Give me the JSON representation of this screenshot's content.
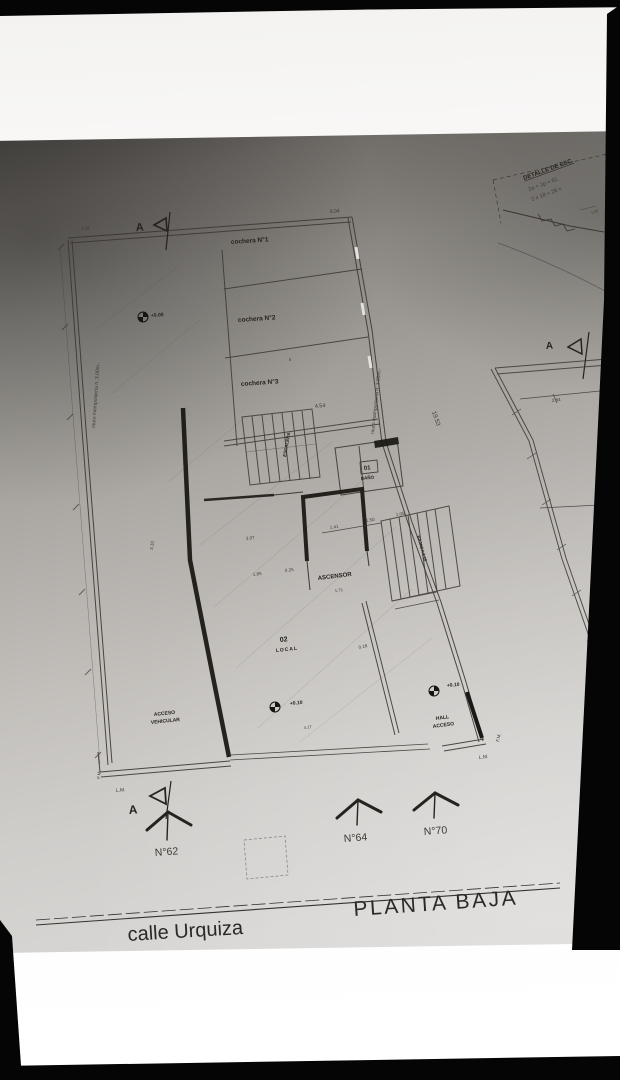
{
  "meta": {
    "description": "Photograph of an architectural ground-floor plan drawing",
    "drawing_title": "PLANTA BAJA",
    "street_label": "calle Urquiza",
    "ink_color": "#3b3834",
    "bold_ink_color": "#26231f",
    "paper_dark": "#4f4c48",
    "paper_light": "#dbd9d7"
  },
  "plan": {
    "title": "PLANTA BAJA",
    "street": "calle Urquiza",
    "detail_note": [
      "DETALLE DE ESC.",
      "2a + 1p = 61",
      "2 x 18 + 26 ="
    ],
    "entries": [
      "N°62",
      "N°64",
      "N°70"
    ],
    "rooms": [
      "cochera N°1",
      "cochera N°2",
      "cochera N°3",
      "LOCAL 02",
      "BAÑO 01",
      "ASCENSOR",
      "ACCESO VEHICULAR",
      "HALL ACCESO"
    ],
    "levels": [
      "+0.00",
      "+0.10",
      "+0.10"
    ],
    "texts": [
      {
        "n": "lm-label-top",
        "t": "L.M.",
        "x": 82,
        "y": 230,
        "s": 4.5,
        "r": -4
      },
      {
        "n": "dim-8-04",
        "t": "8.04",
        "x": 330,
        "y": 213,
        "s": 5,
        "r": -4
      },
      {
        "n": "section-a-top-label",
        "t": "A",
        "x": 136,
        "y": 231,
        "s": 11,
        "r": -4,
        "b": 1
      },
      {
        "n": "room-label-cochera-1",
        "t": "cochera  N°1",
        "x": 231,
        "y": 244,
        "s": 6.5,
        "r": -4,
        "b": 1
      },
      {
        "n": "room-label-cochera-2",
        "t": "cochera  N°2",
        "x": 238,
        "y": 322,
        "s": 6.5,
        "r": -4,
        "b": 1
      },
      {
        "n": "room-label-cochera-3",
        "t": "cochera  N°3",
        "x": 241,
        "y": 386,
        "s": 6.5,
        "r": -4,
        "b": 1
      },
      {
        "n": "wall-label-muro-left",
        "t": "muro mampostería h: 3.00m.-",
        "x": 95,
        "y": 428,
        "s": 5,
        "r": -86
      },
      {
        "n": "wall-label-muro-right",
        "t": "muro mampostería h: 3.00m.-",
        "x": 374,
        "y": 434,
        "s": 5,
        "r": -84
      },
      {
        "n": "level-marker-patio-label",
        "t": "+0.00",
        "x": 151,
        "y": 317,
        "s": 5,
        "r": -4,
        "b": 1
      },
      {
        "n": "dim-5",
        "t": "5",
        "x": 289,
        "y": 361,
        "s": 4,
        "r": -5
      },
      {
        "n": "dim-4-54",
        "t": "4.54",
        "x": 315,
        "y": 408,
        "s": 5.5,
        "r": -6
      },
      {
        "n": "dim-19-53",
        "t": "19.53",
        "x": 432,
        "y": 412,
        "s": 6,
        "r": 71
      },
      {
        "n": "stair-label-escalera",
        "t": "ESCALERA",
        "x": 286,
        "y": 457,
        "s": 4.5,
        "r": -80,
        "b": 1
      },
      {
        "n": "room-label-bano-number",
        "t": "01",
        "x": 364,
        "y": 470,
        "s": 6,
        "r": -6,
        "b": 1
      },
      {
        "n": "room-label-bano",
        "t": "BAÑO",
        "x": 361,
        "y": 480,
        "s": 4.5,
        "r": -6,
        "b": 1
      },
      {
        "n": "room-label-ascensor",
        "t": "ASCENSOR",
        "x": 318,
        "y": 580,
        "s": 6,
        "r": -7,
        "b": 1
      },
      {
        "n": "stair-label-bajada",
        "t": "BAJADA 1.10",
        "x": 417,
        "y": 536,
        "s": 4.2,
        "r": 74,
        "b": 1
      },
      {
        "n": "dim-1-41",
        "t": "1.41",
        "x": 330,
        "y": 529,
        "s": 4.5,
        "r": -8
      },
      {
        "n": "dim-1-50",
        "t": "1.50",
        "x": 366,
        "y": 522,
        "s": 4.5,
        "r": -8
      },
      {
        "n": "dim-1-05",
        "t": "1.05",
        "x": 396,
        "y": 516,
        "s": 4.5,
        "r": -8
      },
      {
        "n": "dim-3-97",
        "t": "3.97",
        "x": 246,
        "y": 540,
        "s": 4.5,
        "r": -7
      },
      {
        "n": "dim-3-10",
        "t": "3.10",
        "x": 153,
        "y": 550,
        "s": 4.5,
        "r": -84
      },
      {
        "n": "dim-1-85",
        "t": "1.85",
        "x": 253,
        "y": 576,
        "s": 4.5,
        "r": -7
      },
      {
        "n": "dim-0-25",
        "t": "0.25",
        "x": 285,
        "y": 572,
        "s": 4.5,
        "r": -7
      },
      {
        "n": "dim-1-73",
        "t": "1.73",
        "x": 335,
        "y": 592,
        "s": 4,
        "r": -7
      },
      {
        "n": "room-label-local-number",
        "t": "02",
        "x": 280,
        "y": 642,
        "s": 7,
        "r": -6,
        "b": 1
      },
      {
        "n": "room-label-local",
        "t": "LOCAL",
        "x": 276,
        "y": 652,
        "s": 5,
        "r": -6,
        "b": 1,
        "ls": 1
      },
      {
        "n": "dim-0-18",
        "t": "0.18",
        "x": 359,
        "y": 649,
        "s": 4.5,
        "r": -14
      },
      {
        "n": "level-marker-local-label",
        "t": "+0.10",
        "x": 290,
        "y": 705,
        "s": 5,
        "r": -5,
        "b": 1
      },
      {
        "n": "room-label-acceso-line1",
        "t": "ACCESO",
        "x": 154,
        "y": 716,
        "s": 5,
        "r": -6,
        "b": 1
      },
      {
        "n": "room-label-acceso-line2",
        "t": "VEHICULAR",
        "x": 151,
        "y": 724,
        "s": 5,
        "r": -6,
        "b": 1
      },
      {
        "n": "dim-4-17",
        "t": "4.17",
        "x": 304,
        "y": 729,
        "s": 4,
        "r": -6
      },
      {
        "n": "level-marker-hall-label",
        "t": "+0.10",
        "x": 447,
        "y": 687,
        "s": 5,
        "r": -5,
        "b": 1
      },
      {
        "n": "room-label-hall-line1",
        "t": "HALL",
        "x": 436,
        "y": 720,
        "s": 5,
        "r": -8,
        "b": 1
      },
      {
        "n": "room-label-hall-line2",
        "t": "ACCESO",
        "x": 433,
        "y": 728,
        "s": 5,
        "r": -8,
        "b": 1
      },
      {
        "n": "fm-label-right",
        "t": "F.M.",
        "x": 499,
        "y": 742,
        "s": 4.5,
        "r": -78
      },
      {
        "n": "lm-label-right",
        "t": "L.M.",
        "x": 479,
        "y": 759,
        "s": 5,
        "r": -7
      },
      {
        "n": "fm-label-left",
        "t": "F.M.",
        "x": 100,
        "y": 779,
        "s": 4.5,
        "r": -84
      },
      {
        "n": "lm-label-left",
        "t": "L.M.",
        "x": 116,
        "y": 792,
        "s": 5,
        "r": -5
      },
      {
        "n": "section-a-bottom-label",
        "t": "A",
        "x": 129,
        "y": 814,
        "s": 12,
        "r": -4,
        "b": 1
      },
      {
        "n": "entry-label-n62",
        "t": "N°62",
        "x": 155,
        "y": 856,
        "s": 10.5,
        "r": -4
      },
      {
        "n": "entry-label-n64",
        "t": "N°64",
        "x": 344,
        "y": 842,
        "s": 10.5,
        "r": -4
      },
      {
        "n": "entry-label-n70",
        "t": "N°70",
        "x": 424,
        "y": 835,
        "s": 10.5,
        "r": -4
      },
      {
        "n": "street-label",
        "t": "calle Urquiza",
        "x": 128,
        "y": 941,
        "s": 20,
        "r": -3.5,
        "c": "#2b2926"
      },
      {
        "n": "drawing-title",
        "t": "PLANTA BAJA",
        "x": 354,
        "y": 916,
        "s": 21,
        "r": -4,
        "ls": 2.5,
        "c": "#2b2926"
      },
      {
        "n": "detail-note-title",
        "t": "DETALLE DE ESC.",
        "x": 524,
        "y": 180,
        "s": 6,
        "r": -20,
        "u": 1,
        "b": 1
      },
      {
        "n": "detail-note-line2",
        "t": "2a + 1p = 61",
        "x": 529,
        "y": 191,
        "s": 5.5,
        "r": -20
      },
      {
        "n": "detail-note-line3",
        "t": "2 x 18 + 26 =",
        "x": 532,
        "y": 201,
        "s": 5.5,
        "r": -20
      },
      {
        "n": "detail-dim-0-26",
        "t": "0.26",
        "x": 592,
        "y": 214,
        "s": 3.5,
        "r": -20
      },
      {
        "n": "section-a-right-label",
        "t": "A",
        "x": 546,
        "y": 349,
        "s": 10,
        "r": -4,
        "b": 1
      },
      {
        "n": "dim-2-84",
        "t": "2.84",
        "x": 552,
        "y": 402,
        "s": 4.5,
        "r": -7
      }
    ]
  }
}
